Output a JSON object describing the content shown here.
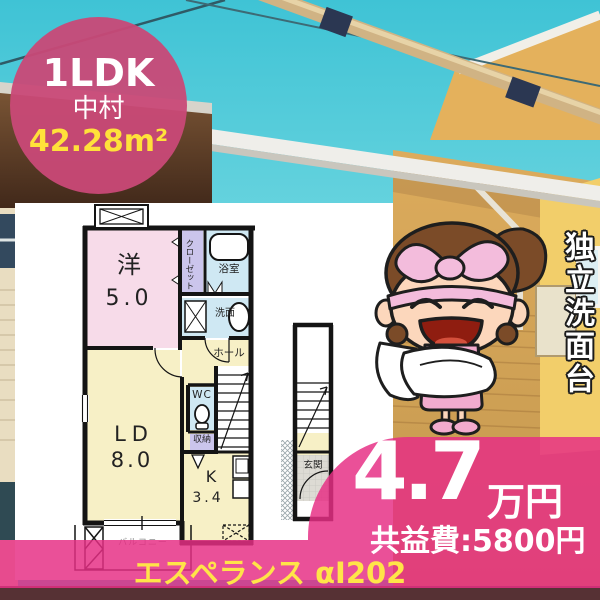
{
  "badge": {
    "layout_type": "1LDK",
    "location": "中村",
    "area": "42.28m²"
  },
  "floorplan": {
    "western_room_label": "洋",
    "western_room_size": "5.0",
    "closet": "クローゼット",
    "bathroom": "浴室",
    "washbasin": "洗面",
    "hall": "ホール",
    "toilet": "WC",
    "storage": "収納",
    "living_dining_label": "LD",
    "living_dining_size": "8.0",
    "kitchen_label": "K",
    "kitchen_size": "3.4",
    "entrance": "玄関",
    "balcony": "バルコニー"
  },
  "feature_banner": "独立洗面台",
  "price": {
    "rent": "4.7",
    "unit": "万円",
    "common_fee": "共益費:5800円"
  },
  "property_name": "エスペランス αI202",
  "colors": {
    "accent_pink": "#e62e84",
    "badge_pink": "#c94f78",
    "highlight_yellow": "#ffe13a",
    "sky_cyan": "#43c5d6"
  }
}
